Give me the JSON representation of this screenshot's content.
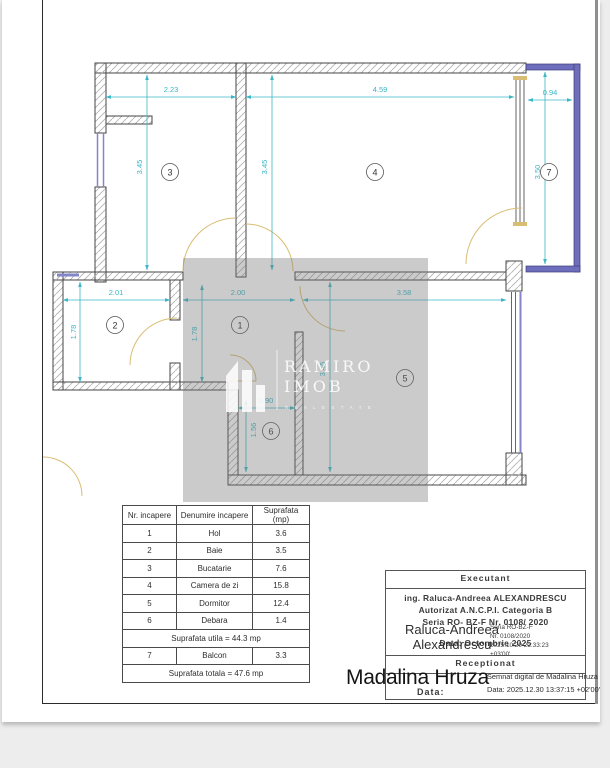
{
  "floor_plan": {
    "rooms": {
      "r1": "1",
      "r2": "2",
      "r3": "3",
      "r4": "4",
      "r5": "5",
      "r6": "6",
      "r7": "7"
    },
    "dimensions": {
      "room3_width": "2.23",
      "room4_width": "4.59",
      "balcony_width": "0.94",
      "room3_height": "3.45",
      "room4_height": "3.45",
      "balcony_height": "3.50",
      "room2_width": "2.01",
      "room2_height": "1.78",
      "hall_width": "2.00",
      "hall_height": "1.78",
      "room5_width": "3.58",
      "room5_height": "3.45",
      "room6_width": "0.90",
      "room6_height": "1.56"
    },
    "watermark": {
      "brand_line1": "RAMIRO",
      "brand_line2": "IMOB",
      "tagline": "R E A L   E S T A T E"
    },
    "colors": {
      "dimension": "#3ab7c6",
      "door": "#d9bd72",
      "window": "#8585c9",
      "balcony_wall": "#6e6ebc",
      "wall_outline": "#444444"
    }
  },
  "area_table": {
    "headers": {
      "nr": "Nr. incapere",
      "name": "Denumire incapere",
      "area": "Suprafata (mp)"
    },
    "rows": [
      {
        "nr": "1",
        "name": "Hol",
        "area": "3.6"
      },
      {
        "nr": "2",
        "name": "Baie",
        "area": "3.5"
      },
      {
        "nr": "3",
        "name": "Bucatarie",
        "area": "7.6"
      },
      {
        "nr": "4",
        "name": "Camera de zi",
        "area": "15.8"
      },
      {
        "nr": "5",
        "name": "Dormitor",
        "area": "12.4"
      },
      {
        "nr": "6",
        "name": "Debara",
        "area": "1.4"
      }
    ],
    "utila": "Suprafata utila = 44.3 mp",
    "balcony_row": {
      "nr": "7",
      "name": "Balcon",
      "area": "3.3"
    },
    "totala": "Suprafata totala = 47.6 mp"
  },
  "executant": {
    "title": "Executant",
    "line1": "ing. Raluca-Andreea ALEXANDRESCU",
    "line2": "Autorizat A.N.C.P.I. Categoria B",
    "line3": "Seria RO- BZ-F  Nr. 0108/ 2020",
    "data_line": "Data: Octombrie 2025",
    "signature_name_line1": "Raluca-Andreea",
    "signature_name_line2": "Alexandrescu",
    "signature_details": [
      "Seria RO-BZ-F",
      "Nr. 0108/2020",
      "2025.10.20 22:33:23",
      "+03'00'"
    ]
  },
  "receptionat": {
    "title": "Receptionat",
    "signature_name": "Madalina Hruza",
    "signature_line1": "Semnat digital de Madalina Hruza",
    "signature_line2": "Data: 2025.12.30 13:37:15 +02'00'",
    "data_label": "Data:"
  }
}
